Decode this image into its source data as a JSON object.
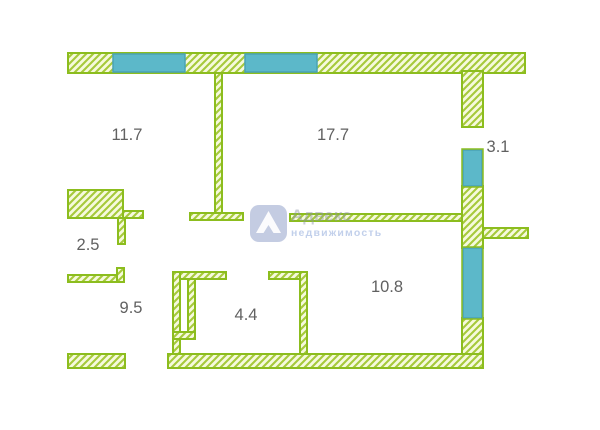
{
  "plan": {
    "type": "apartment-floor-plan",
    "rooms": [
      {
        "id": "room-top-left",
        "area": "11.7"
      },
      {
        "id": "room-top-center",
        "area": "17.7"
      },
      {
        "id": "balcony-right",
        "area": "3.1"
      },
      {
        "id": "hall-left",
        "area": "2.5"
      },
      {
        "id": "room-bottom-left",
        "area": "9.5"
      },
      {
        "id": "room-bottom-mid",
        "area": "4.4"
      },
      {
        "id": "room-bottom-right",
        "area": "10.8"
      }
    ],
    "colors": {
      "wall_outline": "#8cbd1e",
      "wall_hatch_line": "#a6c93b",
      "wall_hatch_bg": "#f6fadd",
      "window_fill": "#5cb8c9",
      "window_edge": "#4aa2b5",
      "label_text": "#616161",
      "watermark_logo": "#a9b4d5",
      "background": "#ffffff"
    }
  },
  "watermark": {
    "line1": "Адвекс",
    "line2": "недвижимость"
  }
}
